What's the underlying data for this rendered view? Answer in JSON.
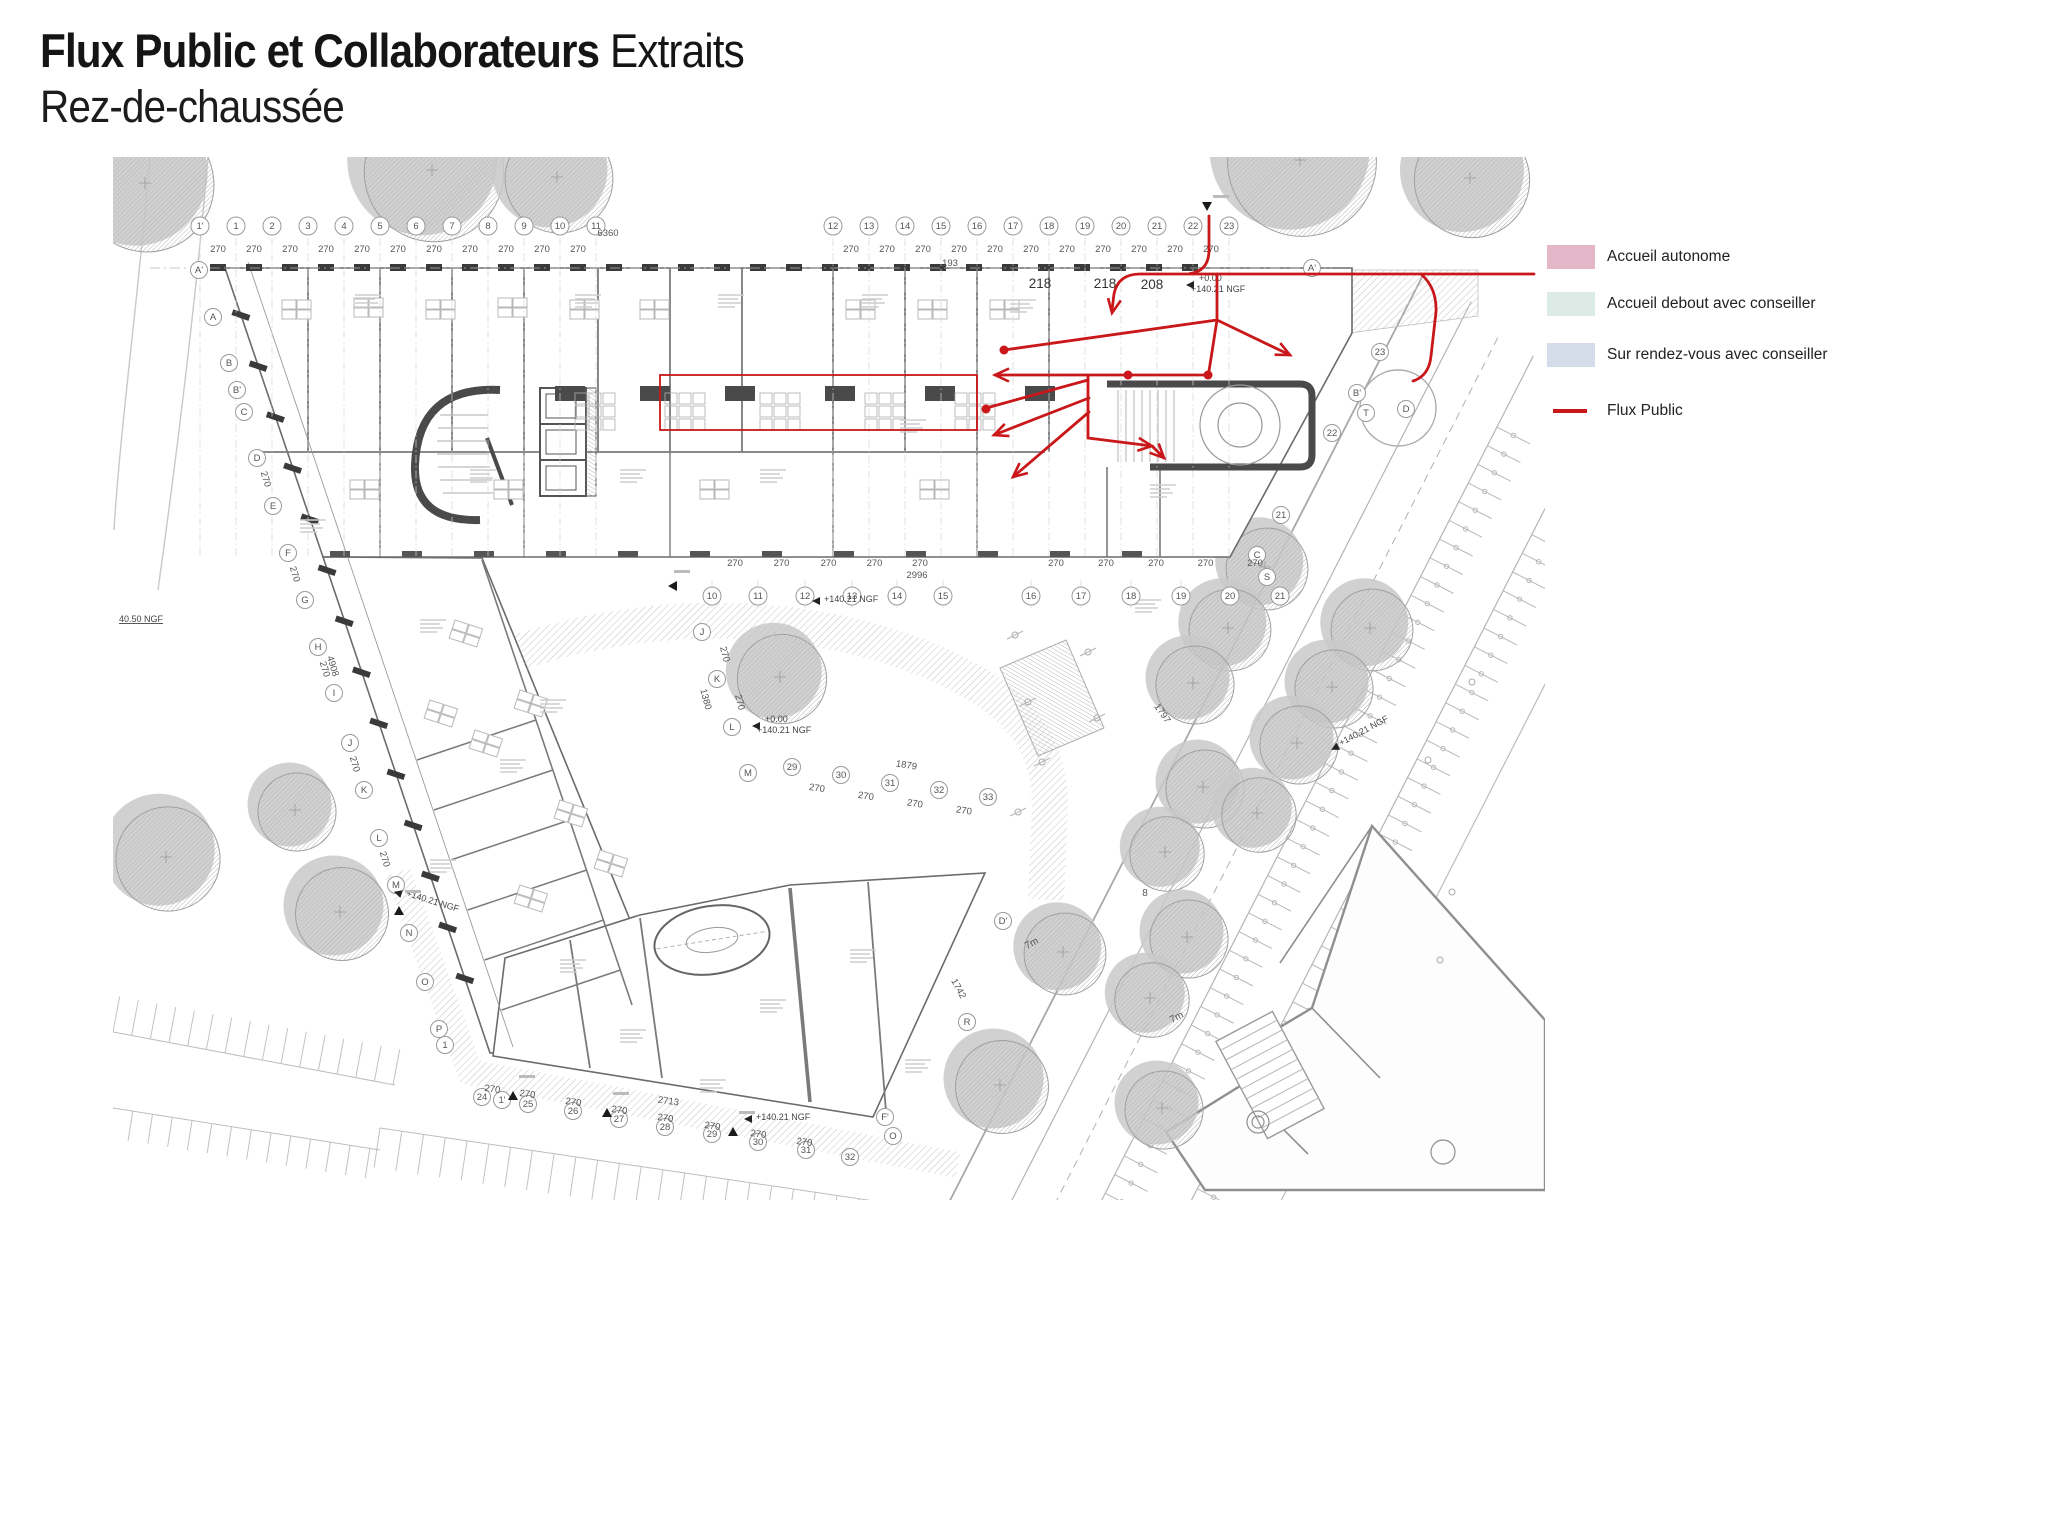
{
  "title": {
    "bold": "Flux Public et Collaborateurs",
    "regular": " Extraits",
    "subtitle": "Rez-de-chaussée"
  },
  "legend": {
    "items": [
      {
        "label": "Accueil autonome",
        "swatch": "#E3B7C8",
        "kind": "fill"
      },
      {
        "label": "Accueil debout avec conseiller",
        "swatch": "#DCEBE5",
        "kind": "fill"
      },
      {
        "label": "Sur rendez-vous avec conseiller",
        "swatch": "#D5DCE9",
        "kind": "fill"
      },
      {
        "label": "Flux Public",
        "swatch": "#C9171A",
        "kind": "line"
      }
    ]
  },
  "colors": {
    "flux": "#C9171A",
    "wall": "#454545",
    "line": "#8a8a8a",
    "faint": "#c4c4c4"
  },
  "plan": {
    "dim_label": "270",
    "grid_top": {
      "y": 226,
      "dim_y": 252,
      "groups": [
        {
          "x0": 200,
          "dx": 36,
          "labels": [
            "1'",
            "1",
            "2",
            "3",
            "4",
            "5",
            "6",
            "7",
            "8",
            "9",
            "10",
            "11"
          ]
        },
        {
          "x0": 833,
          "dx": 36,
          "labels": [
            "12",
            "13",
            "14",
            "15",
            "16",
            "17",
            "18",
            "19",
            "20",
            "21",
            "22",
            "23"
          ]
        }
      ]
    },
    "grid_lower": {
      "y": 596,
      "dim_y": 566,
      "xs": [
        712,
        758,
        805,
        852,
        897,
        943,
        1031,
        1081,
        1131,
        1181,
        1230,
        1280
      ],
      "labels": [
        "10",
        "11",
        "12",
        "13",
        "14",
        "15",
        "16",
        "17",
        "18",
        "19",
        "20",
        "21"
      ]
    },
    "grid_west": [
      [
        "A'",
        199,
        270
      ],
      [
        "A",
        213,
        317
      ],
      [
        "B",
        229,
        363
      ],
      [
        "B'",
        237,
        390
      ],
      [
        "C",
        244,
        412
      ],
      [
        "D",
        257,
        458
      ],
      [
        "E",
        273,
        506
      ],
      [
        "F",
        288,
        553
      ],
      [
        "G",
        305,
        600
      ],
      [
        "H",
        318,
        647
      ],
      [
        "I",
        334,
        693
      ],
      [
        "J",
        350,
        743
      ],
      [
        "K",
        364,
        790
      ],
      [
        "L",
        379,
        838
      ],
      [
        "M",
        396,
        885
      ],
      [
        "N",
        409,
        933
      ],
      [
        "O",
        425,
        982
      ],
      [
        "P",
        439,
        1029
      ],
      [
        "1",
        445,
        1045
      ]
    ],
    "grid_inner": [
      [
        "J",
        702,
        632
      ],
      [
        "K",
        717,
        679
      ],
      [
        "L",
        732,
        727
      ],
      [
        "M",
        748,
        773
      ]
    ],
    "grid_bottom": [
      [
        "24",
        482,
        1097
      ],
      [
        "1'",
        502,
        1100
      ],
      [
        "25",
        528,
        1104
      ],
      [
        "26",
        573,
        1111
      ],
      [
        "27",
        619,
        1119
      ],
      [
        "28",
        665,
        1127
      ],
      [
        "29",
        712,
        1134
      ],
      [
        "30",
        758,
        1142
      ],
      [
        "31",
        806,
        1150
      ],
      [
        "32",
        850,
        1157
      ],
      [
        "F'",
        885,
        1117
      ],
      [
        "O",
        893,
        1136
      ]
    ],
    "grid_bottom_dims": [
      [
        492,
        1092
      ],
      [
        527,
        1097
      ],
      [
        573,
        1105
      ],
      [
        619,
        1113
      ],
      [
        665,
        1121
      ],
      [
        712,
        1129
      ],
      [
        758,
        1137
      ],
      [
        804,
        1145
      ]
    ],
    "grid_courtyard": [
      [
        "29",
        792,
        767
      ],
      [
        "30",
        841,
        775
      ],
      [
        "31",
        890,
        783
      ],
      [
        "32",
        939,
        790
      ],
      [
        "33",
        988,
        797
      ]
    ],
    "grid_right_label": {
      "t": "A'",
      "x": 1312,
      "y": 268
    },
    "street_circles": [
      [
        "B'",
        1357,
        393
      ],
      [
        "T",
        1366,
        413
      ],
      [
        "D",
        1406,
        409
      ],
      [
        "22",
        1332,
        433
      ],
      [
        "23",
        1380,
        352
      ],
      [
        "21",
        1281,
        515
      ],
      [
        "C",
        1257,
        555
      ],
      [
        "S",
        1267,
        577
      ],
      [
        "R",
        967,
        1022
      ],
      [
        "D'",
        1003,
        921
      ]
    ],
    "west_dims": [
      [
        263,
        480
      ],
      [
        292,
        575
      ],
      [
        322,
        670
      ],
      [
        352,
        765
      ],
      [
        382,
        860
      ]
    ],
    "inner_dims": [
      [
        722,
        655
      ],
      [
        737,
        703
      ]
    ],
    "totals": [
      {
        "t": "6360",
        "x": 608,
        "y": 236
      },
      {
        "t": "193",
        "x": 950,
        "y": 266
      },
      {
        "t": "2996",
        "x": 917,
        "y": 578
      },
      {
        "t": "1879",
        "x": 906,
        "y": 768,
        "r": 9
      },
      {
        "t": "2713",
        "x": 668,
        "y": 1104,
        "r": 8
      },
      {
        "t": "4908",
        "x": 330,
        "y": 667,
        "r": 73
      },
      {
        "t": "1380",
        "x": 703,
        "y": 700,
        "r": 75
      },
      {
        "t": "1797",
        "x": 1160,
        "y": 715,
        "r": 55
      },
      {
        "t": "1742",
        "x": 956,
        "y": 990,
        "r": 62
      }
    ],
    "levels": [
      {
        "l1": "+0.00",
        "l2": "+140.21 NGF",
        "x": 1197,
        "y": 283
      },
      {
        "l1": "+0.00",
        "l2": "+140.21 NGF",
        "x": 763,
        "y": 724
      },
      {
        "l2": "+140.21 NGF",
        "x": 823,
        "y": 599
      },
      {
        "l2": "+140.21 NGF",
        "x": 755,
        "y": 1117
      },
      {
        "l2": "+140.21 NGF",
        "x": 1340,
        "y": 743,
        "r": -28
      },
      {
        "l2": "+140.21 NGF",
        "x": 405,
        "y": 893,
        "r": 17
      },
      {
        "l2": "40.50 NGF",
        "x": 118,
        "y": 619,
        "plain": true
      }
    ],
    "room_labels": [
      {
        "t": "218",
        "x": 1040,
        "y": 288
      },
      {
        "t": "218",
        "x": 1105,
        "y": 288
      },
      {
        "t": "208",
        "x": 1152,
        "y": 289
      }
    ],
    "misc_labels": [
      {
        "t": "7m",
        "x": 1033,
        "y": 946,
        "r": -28
      },
      {
        "t": "7m",
        "x": 1178,
        "y": 1020,
        "r": -28
      },
      {
        "t": "8",
        "x": 1145,
        "y": 896
      }
    ],
    "flux": {
      "color": "#C9171A",
      "rect": [
        660,
        375,
        317,
        55
      ],
      "paths": [
        "M1534,274 L1140,274 Q1118,274 1114,294 L1112,310",
        "M1209,216 L1209,250 Q1209,271 1190,273.5",
        "M1217,274 L1217,320",
        "M1217,320 L1004,350",
        "M1217,320 L1290,355",
        "M1217,320 L1209,371",
        "M1208,375 L995,375",
        "M1088,375 L1088,438 L1152,446",
        "M1152,446 L1164,458",
        "M1088,380 L990,407",
        "M1089,398 L994,435",
        "M1089,412 L1013,477",
        "M1421,274 Q1437,288 1436,312 L1431,356 Q1429,376 1413,381"
      ],
      "arrows": [
        [
          1112,
          313,
          100
        ],
        [
          1290,
          355,
          26
        ],
        [
          995,
          375,
          180
        ],
        [
          1152,
          446,
          7
        ],
        [
          1164,
          458,
          45
        ],
        [
          994,
          435,
          159
        ],
        [
          1013,
          477,
          140
        ]
      ],
      "dots": [
        [
          1004,
          350
        ],
        [
          1128,
          375
        ],
        [
          1208,
          375
        ],
        [
          986,
          409
        ]
      ]
    },
    "trees": [
      [
        145,
        183,
        72
      ],
      [
        432,
        170,
        75
      ],
      [
        557,
        177,
        58
      ],
      [
        1300,
        160,
        80
      ],
      [
        1470,
        178,
        62
      ],
      [
        1265,
        567,
        44
      ],
      [
        1228,
        628,
        44
      ],
      [
        1193,
        683,
        42
      ],
      [
        1203,
        787,
        42
      ],
      [
        1165,
        852,
        40
      ],
      [
        1187,
        937,
        42
      ],
      [
        1150,
        998,
        40
      ],
      [
        1162,
        1108,
        42
      ],
      [
        1370,
        628,
        44
      ],
      [
        1332,
        687,
        42
      ],
      [
        1297,
        743,
        42
      ],
      [
        1257,
        813,
        40
      ],
      [
        780,
        677,
        48
      ],
      [
        166,
        857,
        56
      ],
      [
        295,
        810,
        42
      ],
      [
        340,
        912,
        50
      ],
      [
        1000,
        1085,
        50
      ],
      [
        1063,
        952,
        44
      ]
    ],
    "lamps": [
      [
        1015,
        635
      ],
      [
        1088,
        652
      ],
      [
        1028,
        702
      ],
      [
        1097,
        718
      ],
      [
        1042,
        762
      ],
      [
        1018,
        812
      ]
    ],
    "entries": [
      {
        "x": 1207,
        "y": 211,
        "dir": "down"
      },
      {
        "x": 668,
        "y": 586,
        "dir": "left"
      },
      {
        "x": 513,
        "y": 1091,
        "dir": "up"
      },
      {
        "x": 607,
        "y": 1108,
        "dir": "up"
      },
      {
        "x": 733,
        "y": 1127,
        "dir": "up"
      },
      {
        "x": 399,
        "y": 906,
        "dir": "up"
      }
    ]
  }
}
